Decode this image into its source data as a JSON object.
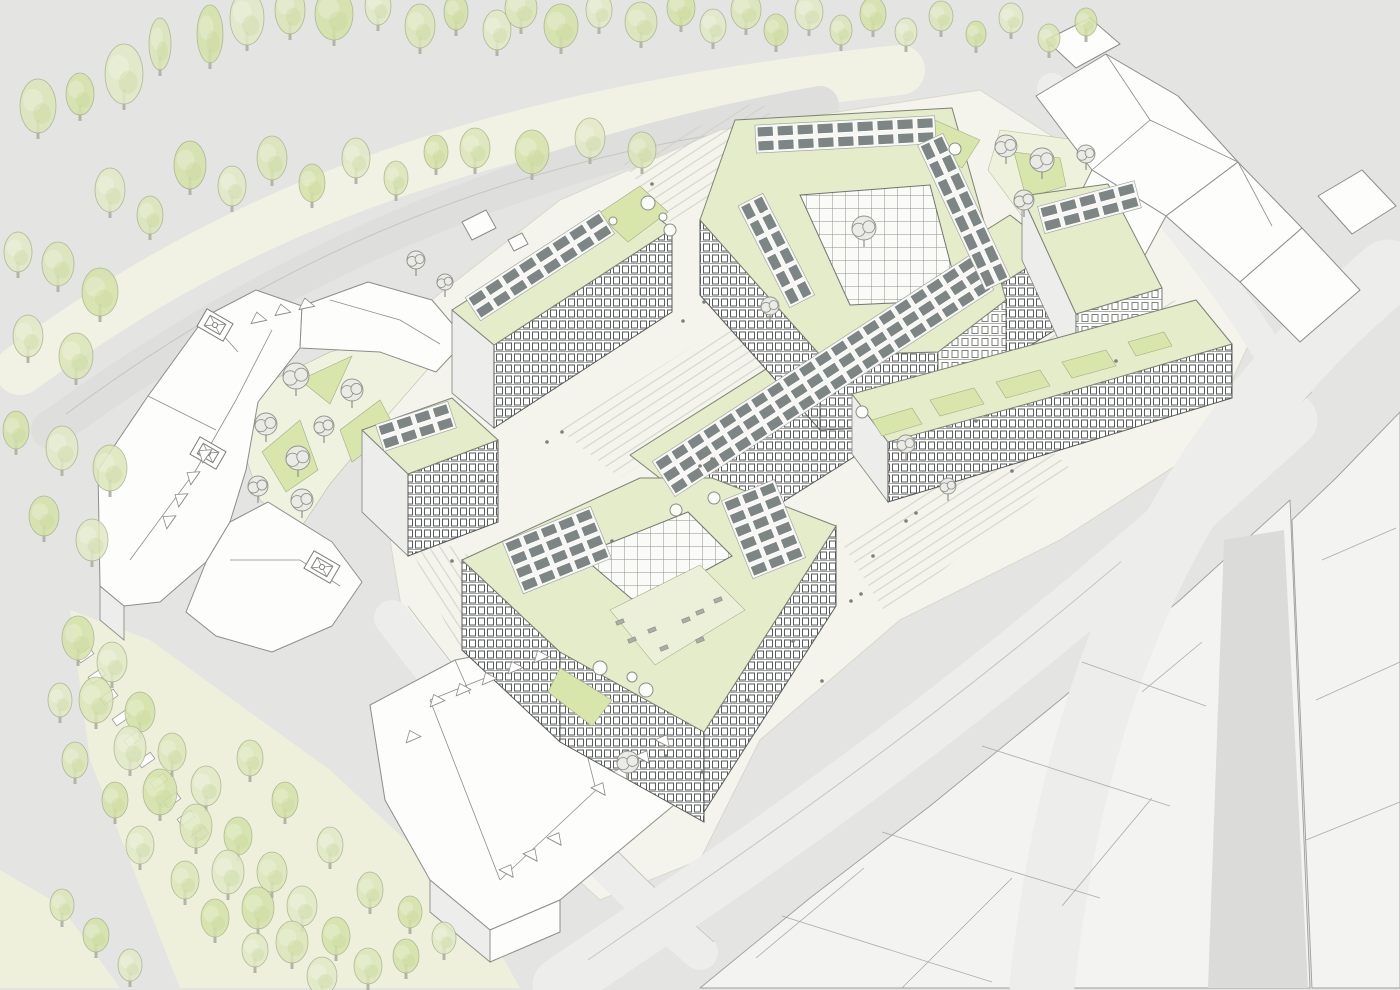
{
  "scene": {
    "type": "architectural-axonometric-site-plan",
    "palette": {
      "bg": "#e4e4e2",
      "plaza": "#f4f4ec",
      "roadCream": "#f1f2e3",
      "roadGray": "#dededd",
      "roadLight": "#ededeb",
      "streetDark": "#dbdbd9",
      "parkBand": "#eef0dc",
      "contextRoof": "#f3f3f1",
      "contextLine": "#9f9f9b",
      "white": "#fdfdfc",
      "greenRoof": "#e4ecca",
      "lawn": "#d8e5ab",
      "lawnLight": "#eef1dc",
      "solar": "#7e8585",
      "treeStroke": "#a6b189",
      "treeDark": "#c3d596",
      "treeFills": [
        "#dce6b8",
        "#d5e2a9",
        "#e2e9c6"
      ],
      "sketchTree": "#90908a",
      "terrace": "#ecf0d8",
      "stairLine": "#cfcfc3",
      "people": "#80807b",
      "shade": "#ededeb",
      "trunk": "#b4b4a8"
    },
    "trees": {
      "fields": "x,y,rx,ry",
      "items": [
        [
          38,
          106,
          18,
          27
        ],
        [
          80,
          94,
          14,
          21
        ],
        [
          124,
          74,
          19,
          30
        ],
        [
          160,
          44,
          11,
          26
        ],
        [
          210,
          34,
          13,
          29
        ],
        [
          247,
          18,
          17,
          27
        ],
        [
          290,
          10,
          15,
          24
        ],
        [
          334,
          14,
          19,
          26
        ],
        [
          378,
          6,
          13,
          19
        ],
        [
          420,
          26,
          15,
          22
        ],
        [
          456,
          12,
          12,
          18
        ],
        [
          497,
          30,
          14,
          20
        ],
        [
          521,
          8,
          16,
          20
        ],
        [
          561,
          26,
          17,
          22
        ],
        [
          599,
          10,
          13,
          18
        ],
        [
          641,
          22,
          16,
          20
        ],
        [
          681,
          8,
          14,
          18
        ],
        [
          713,
          26,
          13,
          17
        ],
        [
          746,
          10,
          15,
          19
        ],
        [
          776,
          30,
          12,
          16
        ],
        [
          809,
          12,
          14,
          18
        ],
        [
          841,
          30,
          11,
          15
        ],
        [
          873,
          14,
          13,
          17
        ],
        [
          906,
          32,
          11,
          14
        ],
        [
          941,
          16,
          12,
          15
        ],
        [
          976,
          34,
          10,
          13
        ],
        [
          1011,
          18,
          12,
          15
        ],
        [
          1049,
          38,
          11,
          14
        ],
        [
          1086,
          22,
          11,
          14
        ],
        [
          110,
          190,
          15,
          22
        ],
        [
          150,
          215,
          13,
          19
        ],
        [
          190,
          165,
          16,
          24
        ],
        [
          232,
          186,
          14,
          20
        ],
        [
          272,
          158,
          15,
          22
        ],
        [
          312,
          183,
          13,
          19
        ],
        [
          356,
          158,
          14,
          20
        ],
        [
          396,
          178,
          12,
          17
        ],
        [
          436,
          152,
          12,
          17
        ],
        [
          18,
          252,
          14,
          20
        ],
        [
          58,
          264,
          16,
          22
        ],
        [
          100,
          292,
          18,
          24
        ],
        [
          28,
          336,
          15,
          21
        ],
        [
          76,
          356,
          17,
          23
        ],
        [
          16,
          430,
          13,
          19
        ],
        [
          62,
          448,
          16,
          22
        ],
        [
          110,
          468,
          17,
          23
        ],
        [
          44,
          516,
          15,
          20
        ],
        [
          92,
          540,
          16,
          21
        ],
        [
          475,
          148,
          15,
          20
        ],
        [
          532,
          152,
          17,
          22
        ],
        [
          590,
          138,
          15,
          20
        ],
        [
          642,
          150,
          14,
          18
        ],
        [
          78,
          638,
          16,
          22
        ],
        [
          112,
          662,
          15,
          20
        ],
        [
          96,
          700,
          17,
          23
        ],
        [
          140,
          712,
          15,
          20
        ],
        [
          130,
          748,
          16,
          22
        ],
        [
          172,
          752,
          14,
          19
        ],
        [
          160,
          792,
          17,
          23
        ],
        [
          206,
          786,
          15,
          20
        ],
        [
          196,
          826,
          16,
          22
        ],
        [
          238,
          836,
          14,
          19
        ],
        [
          228,
          872,
          16,
          22
        ],
        [
          272,
          872,
          15,
          20
        ],
        [
          258,
          908,
          16,
          21
        ],
        [
          302,
          906,
          15,
          20
        ],
        [
          292,
          942,
          16,
          21
        ],
        [
          336,
          936,
          14,
          19
        ],
        [
          322,
          976,
          15,
          19
        ],
        [
          368,
          966,
          14,
          18
        ],
        [
          406,
          956,
          13,
          17
        ],
        [
          444,
          938,
          12,
          16
        ],
        [
          250,
          758,
          13,
          18
        ],
        [
          285,
          800,
          13,
          18
        ],
        [
          330,
          845,
          13,
          18
        ],
        [
          370,
          890,
          13,
          18
        ],
        [
          410,
          912,
          12,
          16
        ],
        [
          60,
          700,
          12,
          17
        ],
        [
          75,
          760,
          13,
          18
        ],
        [
          115,
          800,
          13,
          18
        ],
        [
          140,
          845,
          14,
          19
        ],
        [
          185,
          880,
          14,
          19
        ],
        [
          215,
          918,
          14,
          19
        ],
        [
          255,
          950,
          13,
          17
        ],
        [
          62,
          905,
          12,
          16
        ],
        [
          96,
          935,
          13,
          17
        ],
        [
          130,
          965,
          12,
          16
        ]
      ]
    },
    "sketch_trees": {
      "fields": "x,y,r",
      "items": [
        [
          296,
          376,
          13
        ],
        [
          266,
          424,
          11
        ],
        [
          298,
          458,
          12
        ],
        [
          258,
          486,
          10
        ],
        [
          302,
          500,
          11
        ],
        [
          324,
          426,
          10
        ],
        [
          352,
          390,
          11
        ],
        [
          1006,
          146,
          11
        ],
        [
          1042,
          160,
          12
        ],
        [
          1024,
          200,
          10
        ],
        [
          1086,
          154,
          9
        ],
        [
          628,
          762,
          11
        ],
        [
          906,
          444,
          9
        ],
        [
          864,
          228,
          12
        ],
        [
          770,
          306,
          9
        ],
        [
          948,
          486,
          8
        ],
        [
          445,
          282,
          8
        ],
        [
          416,
          260,
          9
        ]
      ]
    },
    "solar_arrays": {
      "fields": "x,y,rot,rows,cols,pw,ph,gx,gy",
      "items": [
        [
          468,
          298,
          -33,
          2,
          8,
          16,
          10,
          4,
          4
        ],
        [
          655,
          462,
          -33,
          3,
          20,
          15,
          10,
          4,
          4
        ],
        [
          757,
          127,
          -3,
          2,
          9,
          16,
          10,
          4,
          4
        ],
        [
          942,
          136,
          65,
          2,
          8,
          16,
          10,
          4,
          4
        ],
        [
          762,
          196,
          63,
          2,
          6,
          15,
          10,
          4,
          4
        ],
        [
          1040,
          208,
          -15,
          2,
          5,
          16,
          10,
          4,
          4
        ],
        [
          378,
          426,
          -18,
          2,
          4,
          15,
          10,
          4,
          4
        ],
        [
          505,
          543,
          -22,
          4,
          5,
          15,
          10,
          4,
          4
        ],
        [
          724,
          502,
          -22,
          6,
          3,
          15,
          10,
          4,
          4
        ]
      ]
    },
    "skylights": {
      "fields": "x,y,r",
      "items": [
        [
          648,
          203,
          7
        ],
        [
          663,
          217,
          4
        ],
        [
          670,
          230,
          6
        ],
        [
          613,
          221,
          4
        ],
        [
          955,
          149,
          6
        ],
        [
          862,
          412,
          6
        ],
        [
          600,
          668,
          7
        ],
        [
          632,
          677,
          5
        ],
        [
          646,
          690,
          7
        ],
        [
          676,
          510,
          6
        ],
        [
          714,
          498,
          6
        ]
      ]
    },
    "roof_lanterns": {
      "fields": "x,y",
      "items": [
        [
          215,
          325
        ],
        [
          208,
          453
        ],
        [
          322,
          567
        ]
      ]
    },
    "dormers": {
      "fields": "x,y,rot",
      "items": [
        [
          436,
          700,
          -23
        ],
        [
          462,
          689,
          -23
        ],
        [
          488,
          678,
          -23
        ],
        [
          514,
          667,
          -23
        ],
        [
          540,
          656,
          -23
        ],
        [
          600,
          788,
          28
        ],
        [
          622,
          772,
          28
        ],
        [
          644,
          756,
          28
        ],
        [
          664,
          740,
          28
        ],
        [
          508,
          870,
          28
        ],
        [
          532,
          854,
          28
        ],
        [
          556,
          838,
          28
        ],
        [
          412,
          736,
          -23
        ],
        [
          168,
          520,
          -55
        ],
        [
          180,
          498,
          -55
        ],
        [
          192,
          476,
          -55
        ],
        [
          204,
          454,
          -55
        ],
        [
          258,
          318,
          -12
        ],
        [
          282,
          310,
          -12
        ],
        [
          306,
          304,
          -12
        ]
      ]
    },
    "park_steps": {
      "fields": "x,y",
      "items": [
        [
          85,
          655
        ],
        [
          97,
          676
        ],
        [
          109,
          697
        ],
        [
          121,
          718
        ],
        [
          133,
          739
        ],
        [
          146,
          760
        ],
        [
          159,
          781
        ],
        [
          172,
          800
        ],
        [
          186,
          818
        ],
        [
          200,
          835
        ]
      ]
    },
    "terrace_furniture": {
      "fields": "x,y",
      "items": [
        [
          620,
          622
        ],
        [
          632,
          640
        ],
        [
          652,
          630
        ],
        [
          664,
          648
        ],
        [
          686,
          620
        ],
        [
          700,
          640
        ],
        [
          700,
          612
        ],
        [
          718,
          600
        ]
      ]
    },
    "people": {
      "fields": "x,y",
      "items": [
        [
          700,
          466
        ],
        [
          712,
          459
        ],
        [
          851,
          601
        ],
        [
          861,
          594
        ],
        [
          793,
          641
        ],
        [
          704,
          302
        ],
        [
          683,
          321
        ],
        [
          562,
          432
        ],
        [
          547,
          442
        ],
        [
          906,
          521
        ],
        [
          916,
          513
        ],
        [
          1012,
          471
        ],
        [
          822,
          681
        ],
        [
          702,
          772
        ],
        [
          612,
          541
        ],
        [
          482,
          481
        ],
        [
          452,
          561
        ],
        [
          976,
          421
        ],
        [
          1116,
          361
        ],
        [
          762,
          211
        ],
        [
          652,
          184
        ],
        [
          873,
          556
        ],
        [
          748,
          700
        ],
        [
          666,
          756
        ]
      ]
    }
  }
}
